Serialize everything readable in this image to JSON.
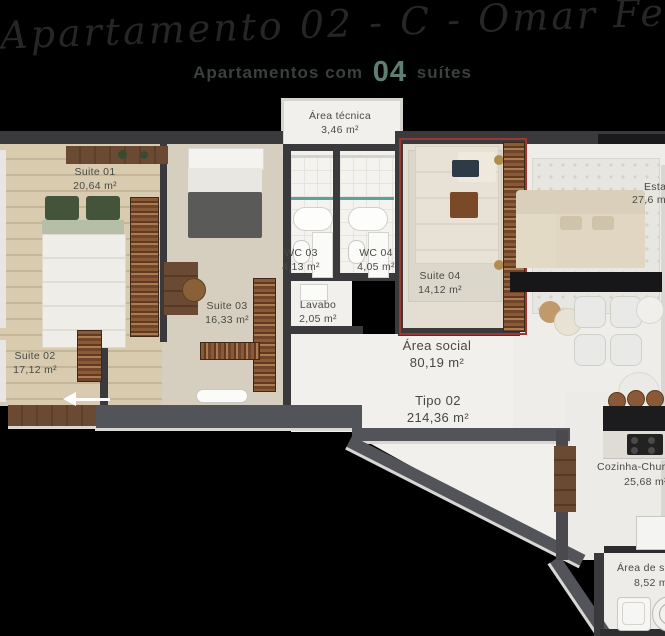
{
  "header": {
    "script_title": "Apartamento 02 - C - Omar Ferreira",
    "subtitle_prefix": "Apartamentos com",
    "subtitle_number": "04",
    "subtitle_suffix": "suítes"
  },
  "rooms": {
    "tecnica": {
      "name": "Área técnica",
      "area": "3,46 m²"
    },
    "s1": {
      "name": "Suite 01",
      "area": "20,64 m²"
    },
    "s2": {
      "name": "Suite 02",
      "area": "17,12 m²"
    },
    "s3": {
      "name": "Suite 03",
      "area": "16,33 m²"
    },
    "s4": {
      "name": "Suite 04",
      "area": "14,12 m²"
    },
    "wc3": {
      "name": "WC 03",
      "area": "4,13 m²"
    },
    "wc4": {
      "name": "WC 04",
      "area": "4,05 m²"
    },
    "lavabo": {
      "name": "Lavabo",
      "area": "2,05 m²"
    },
    "social": {
      "name": "Área social",
      "area": "80,19 m²"
    },
    "tipo": {
      "name": "Tipo 02",
      "area": "214,36 m²"
    },
    "estar": {
      "name": "Estar",
      "area": "27,6 m²"
    },
    "cozinha": {
      "name": "Cozinha-Churrasqueira",
      "area": "25,68 m²"
    },
    "servico": {
      "name": "Área de serviço",
      "area": "8,52 m²"
    }
  },
  "colors": {
    "background": "#000000",
    "accent_teal": "#5e7f71",
    "highlight_red": "#9e3732",
    "wall_dark": "#3a3a3c",
    "wood_floor": "#d8cbb0"
  },
  "icons": {
    "entrance_arrow": "←"
  }
}
